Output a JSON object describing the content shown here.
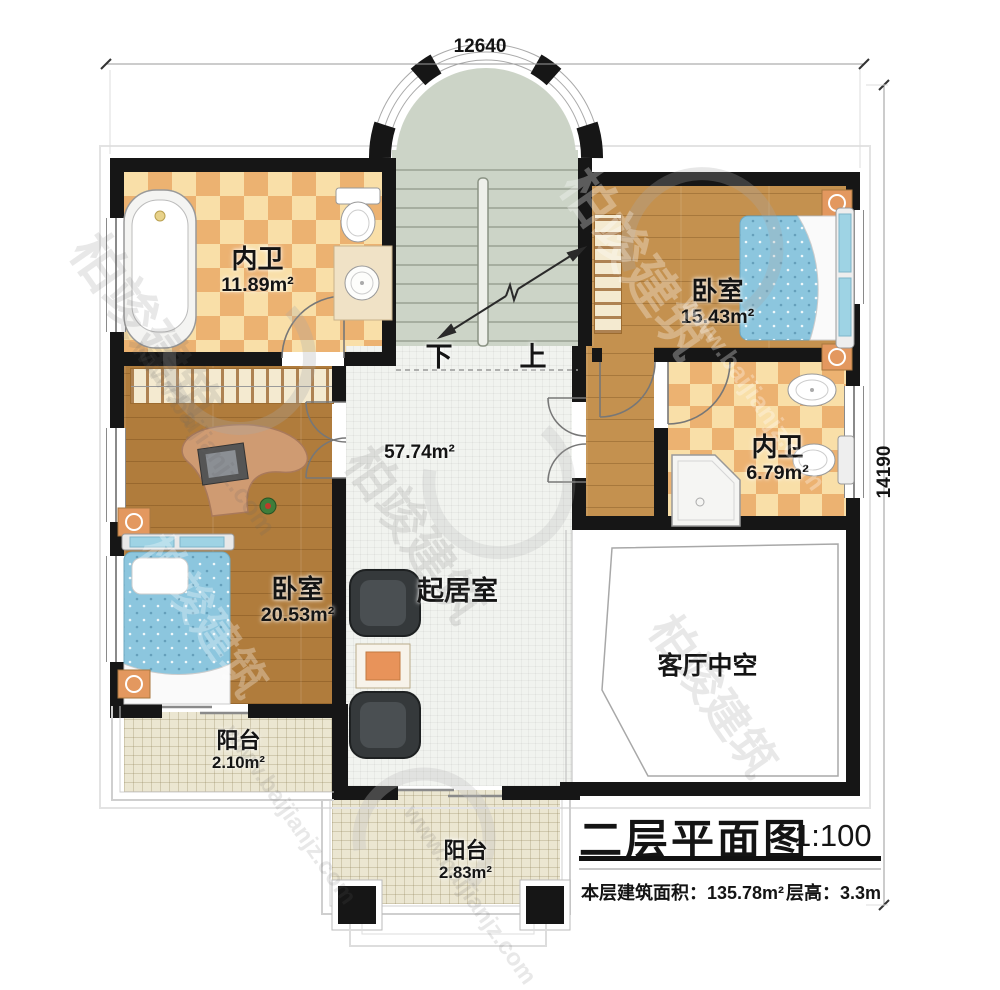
{
  "watermark": {
    "brand": "柏竣建筑",
    "url": "www.baijianjz.com"
  },
  "plan": {
    "dimensions": {
      "top": "12640",
      "right": "14190"
    },
    "rooms": [
      {
        "name": "内卫",
        "area": "11.89m²"
      },
      {
        "name": "卧室",
        "area": "15.43m²"
      },
      {
        "name": "内卫",
        "area": "6.79m²"
      },
      {
        "name": "卧室",
        "area": "20.53m²"
      },
      {
        "name": "起居室",
        "area": "57.74m²"
      },
      {
        "name": "客厅中空",
        "area": ""
      },
      {
        "name": "阳台",
        "area": "2.10m²"
      },
      {
        "name": "阳台",
        "area": "2.83m²"
      }
    ],
    "stairs": {
      "down": "下",
      "up": "上"
    },
    "title_block": {
      "title": "二层平面图",
      "scale": "1:100",
      "floor_area": "本层建筑面积：135.78m²",
      "floor_height": "层高：3.3m"
    }
  }
}
